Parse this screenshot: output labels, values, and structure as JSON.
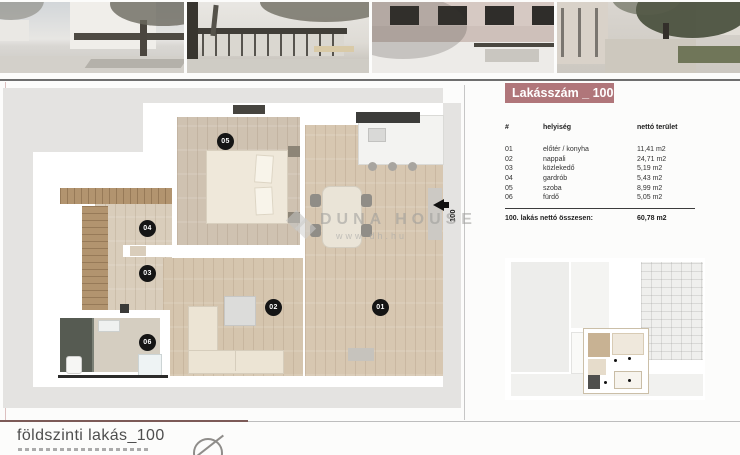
{
  "photos": {
    "labels": [
      "exterior-street-render",
      "garden-pavilion-render",
      "brick-facade-render",
      "courtyard-render"
    ]
  },
  "apartment_panel": {
    "header_label": "Lakásszám _ 100",
    "table": {
      "columns": [
        "#",
        "helyiség",
        "nettó terület"
      ],
      "rows": [
        {
          "num": "01",
          "room": "előtér / konyha",
          "area": "11,41 m2"
        },
        {
          "num": "02",
          "room": "nappali",
          "area": "24,71 m2"
        },
        {
          "num": "03",
          "room": "közlekedő",
          "area": "5,19 m2"
        },
        {
          "num": "04",
          "room": "gardrób",
          "area": "5,43 m2"
        },
        {
          "num": "05",
          "room": "szoba",
          "area": "8,99 m2"
        },
        {
          "num": "06",
          "room": "fürdő",
          "area": "5,05 m2"
        }
      ],
      "total_label": "100. lakás nettó összesen:",
      "total_value": "60,78 m2"
    }
  },
  "plan": {
    "markers": [
      "01",
      "02",
      "03",
      "04",
      "05",
      "06"
    ],
    "entrance_label": "100"
  },
  "watermark": {
    "brand": "DUNA HOUSE",
    "url": "www.dh.hu"
  },
  "footer": {
    "title": "földszinti lakás_100"
  },
  "colors": {
    "accent_rose": "#b0767a",
    "slab_gray": "#e4e3e1",
    "wood_floor": "#d6c6b0",
    "marker_black": "#151515"
  }
}
